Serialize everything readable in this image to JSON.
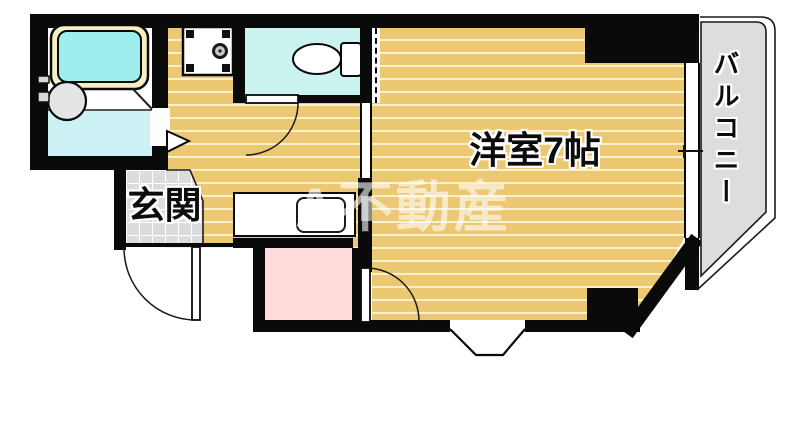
{
  "floorplan": {
    "rooms": {
      "western_room": {
        "label": "洋室7帖"
      },
      "genkan": {
        "label": "玄関"
      },
      "balcony": {
        "label": "バルコニー"
      }
    },
    "watermark": {
      "text": "A不動産"
    },
    "fixtures": [
      "bathtub",
      "bathroom-sink",
      "washing-machine-pan",
      "toilet",
      "kitchen-sink",
      "bay-window"
    ],
    "colors": {
      "wood_floor": "#ECC873",
      "wood_stripe": "#F9F1CC",
      "toilet_floor": "#CBF4F1",
      "bath_floor": "#CDF2F6",
      "bath_water": "#9DEEEC",
      "tub_rim": "#F4F0C4",
      "closet_pink": "#FFDBDB",
      "tile_gray": "#DCDCDC",
      "balcony_gray": "#DDDDDD",
      "wall_black": "#0A0A0A"
    }
  }
}
